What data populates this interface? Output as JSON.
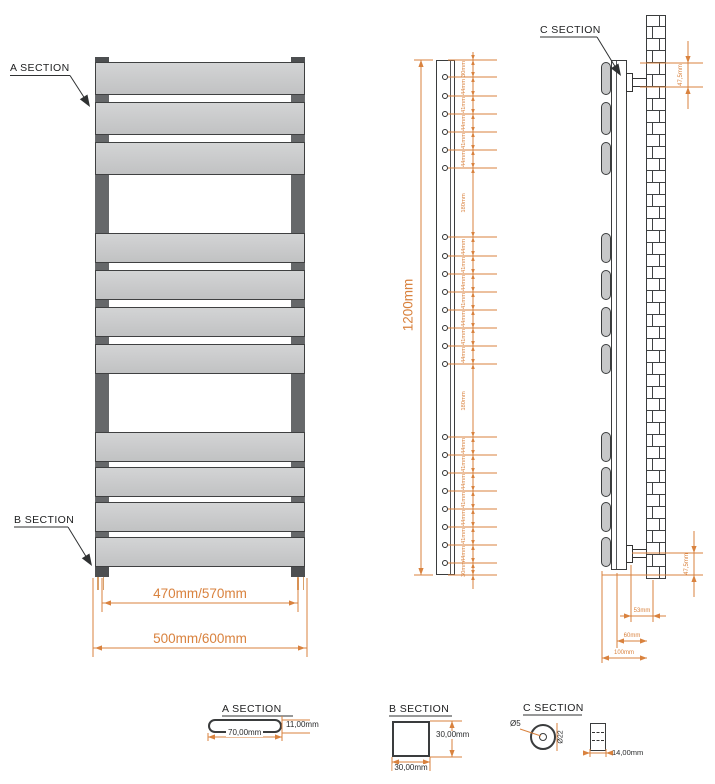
{
  "sections": {
    "a_label": "A SECTION",
    "b_label": "B SECTION",
    "c_label": "C SECTION"
  },
  "front_view": {
    "inner_width_dim": "470mm/570mm",
    "outer_width_dim": "500mm/600mm",
    "panel_groups": [
      3,
      4,
      4
    ]
  },
  "side_view": {
    "height_dim": "1200mm",
    "hole_groups": [
      6,
      8,
      8
    ],
    "segment_dims": [
      "30mm",
      "44mm",
      "41mm",
      "44mm",
      "41mm",
      "44mm",
      "180mm",
      "44mm",
      "41mm",
      "44mm",
      "41mm",
      "44mm",
      "41mm",
      "44mm",
      "180mm",
      "44mm",
      "41mm",
      "44mm",
      "41mm",
      "44mm",
      "41mm",
      "44mm",
      "30mm"
    ]
  },
  "wall_view": {
    "top_offset_dim": "47,5mm",
    "bottom_offset_dim": "47,5mm",
    "bracket_depth_dim": "53mm",
    "rail_to_wall_dim": "60mm",
    "total_depth_dim": "100mm"
  },
  "details": {
    "a": {
      "title": "A SECTION",
      "width_dim": "70,00mm",
      "height_dim": "11,00mm"
    },
    "b": {
      "title": "B SECTION",
      "width_dim": "30,00mm",
      "height_dim": "30,00mm"
    },
    "c": {
      "title": "C SECTION",
      "inner_dia_dim": "Ø5",
      "outer_dia_dim": "Ø22",
      "depth_dim": "14,00mm"
    }
  },
  "colors": {
    "dimension": "#d9823e",
    "line": "#2f3132",
    "panel_fill": "#c7c8c9",
    "rail_fill": "#66686a",
    "pipe": "#d8a06b"
  }
}
